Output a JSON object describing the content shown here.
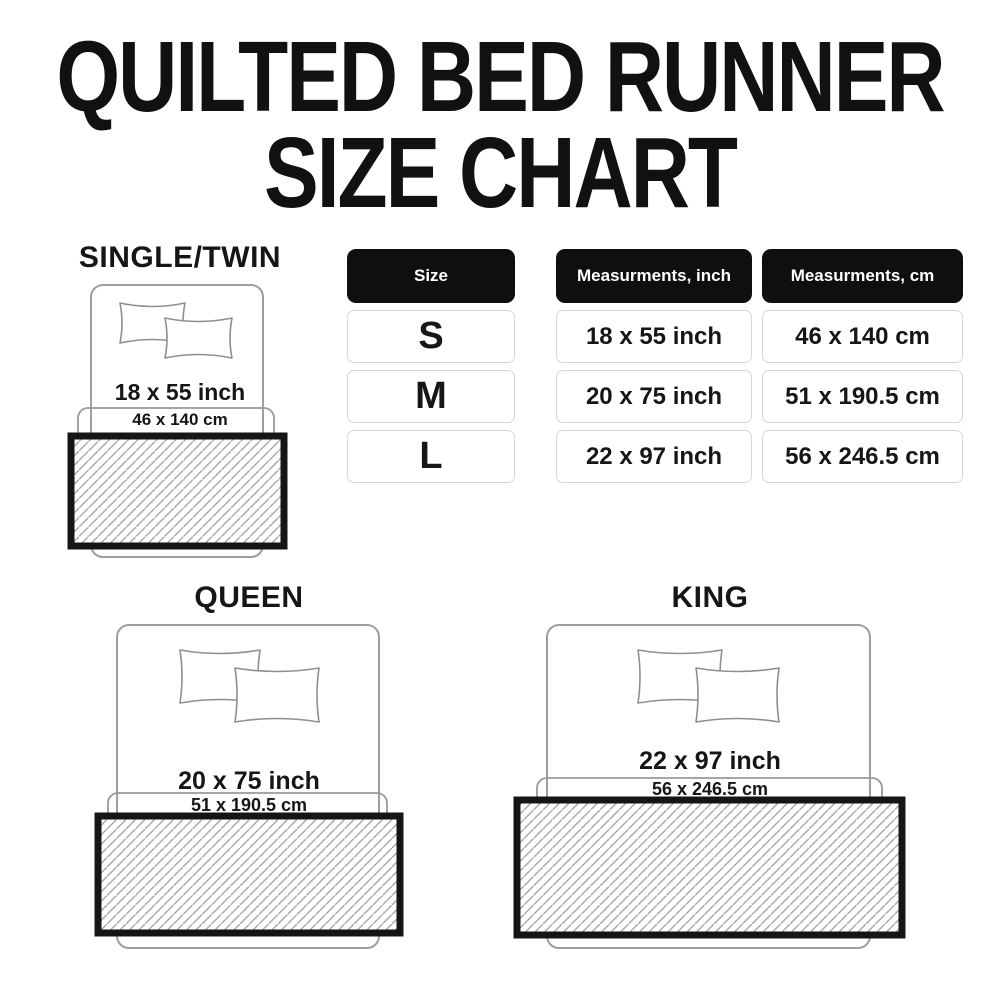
{
  "title": {
    "line1": "QUILTED BED RUNNER",
    "line2": "SIZE CHART"
  },
  "size_table": {
    "columns": [
      "Size",
      "Measurments, inch",
      "Measurments, cm"
    ],
    "rows": [
      {
        "size": "S",
        "inch": "18 x 55 inch",
        "cm": "46 x 140 cm"
      },
      {
        "size": "M",
        "inch": "20 x 75 inch",
        "cm": "51 x 190.5 cm"
      },
      {
        "size": "L",
        "inch": "22 x 97 inch",
        "cm": "56 x 246.5 cm"
      }
    ]
  },
  "diagrams": {
    "single": {
      "label": "SINGLE/TWIN",
      "inch": "18 x 55 inch",
      "cm": "46 x 140 cm"
    },
    "queen": {
      "label": "QUEEN",
      "inch": "20 x 75 inch",
      "cm": "51 x 190.5 cm"
    },
    "king": {
      "label": "KING",
      "inch": "22 x 97 inch",
      "cm": "56 x 246.5 cm"
    }
  },
  "colors": {
    "background": "#ffffff",
    "text": "#1a1a1a",
    "table_header_bg": "#0f0f0f",
    "table_header_text": "#ffffff",
    "table_cell_border": "#d6d6d6",
    "outline_gray": "#9e9e9e",
    "hatch_line": "#a8a8a8",
    "runner_border": "#151515"
  }
}
